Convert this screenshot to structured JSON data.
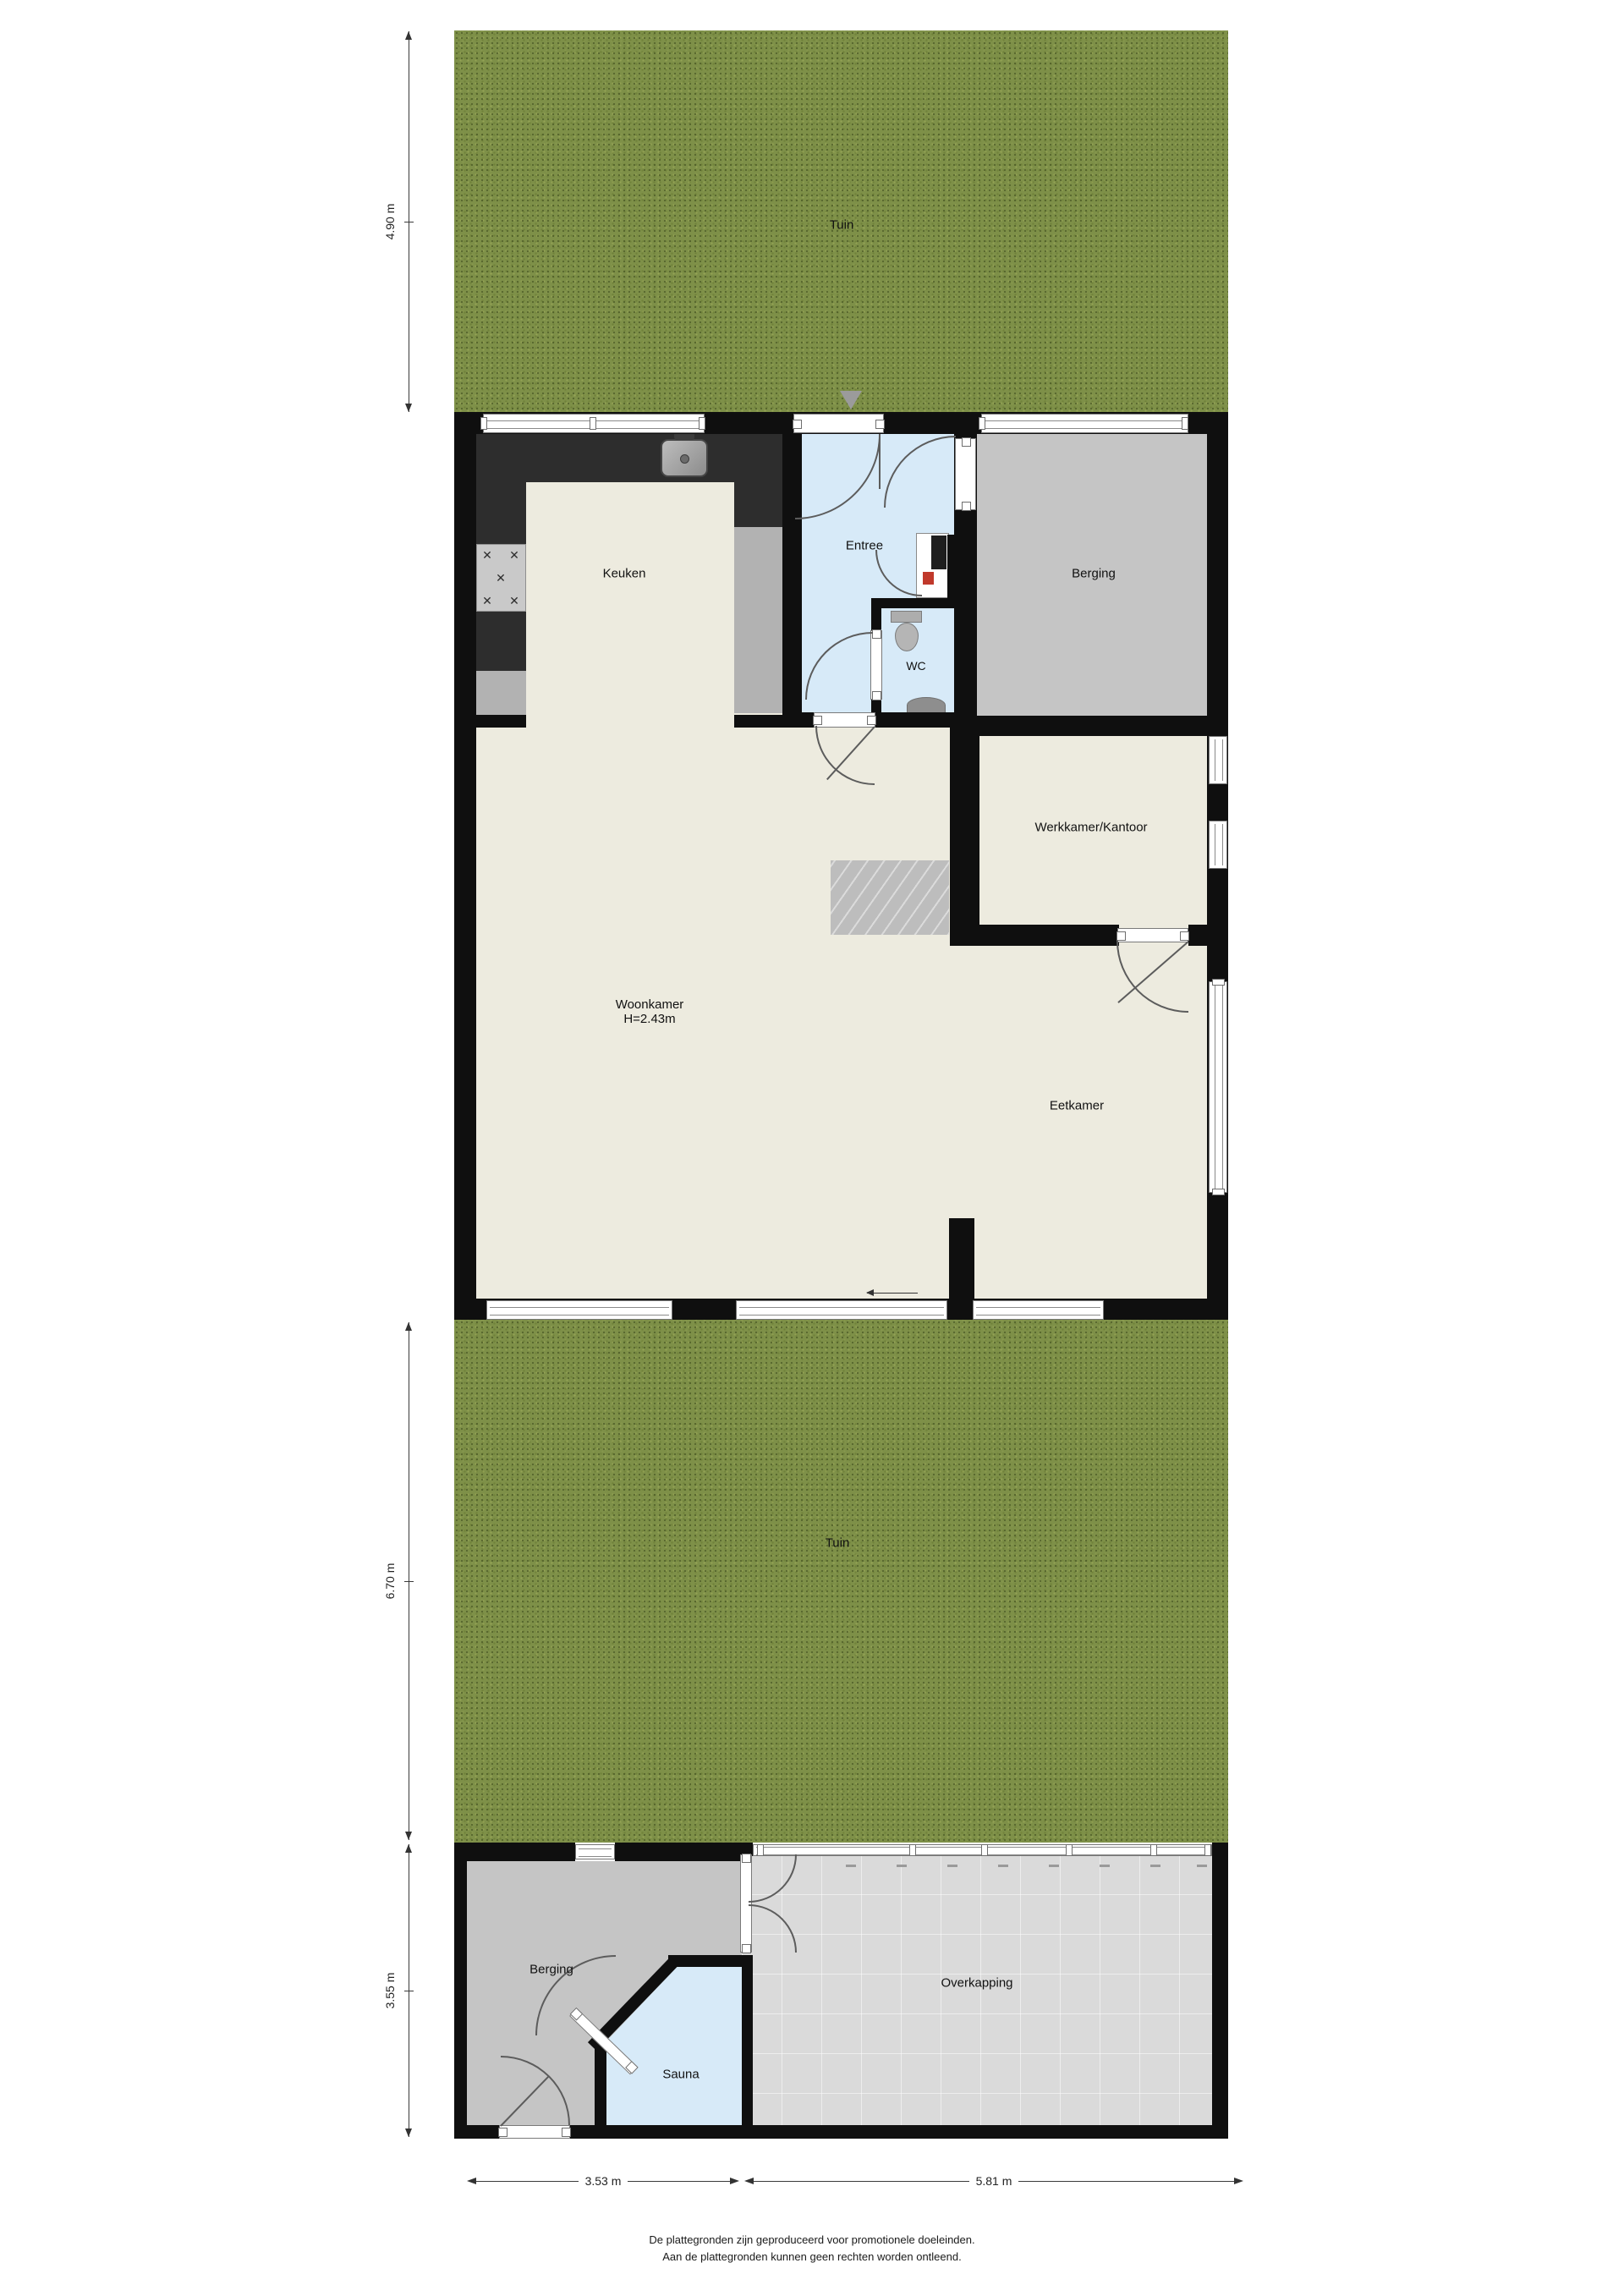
{
  "plan": {
    "rooms": {
      "tuin_top": "Tuin",
      "keuken": "Keuken",
      "entree": "Entree",
      "wc": "WC",
      "berging_top": "Berging",
      "werkkamer": "Werkkamer/Kantoor",
      "woonkamer": "Woonkamer",
      "woonkamer_height": "H=2.43m",
      "eetkamer": "Eetkamer",
      "tuin_bottom": "Tuin",
      "berging_bottom": "Berging",
      "sauna": "Sauna",
      "overkapping": "Overkapping"
    },
    "dimensions": {
      "tuin_top_depth": "4.90 m",
      "tuin_bottom_depth": "6.70 m",
      "outbuilding_depth": "3.55 m",
      "outbuilding_width_left": "3.53 m",
      "outbuilding_width_right": "5.81 m"
    },
    "disclaimer": {
      "line1": "De plattegronden zijn geproduceerd voor promotionele doeleinden.",
      "line2": "Aan de plattegronden kunnen geen rechten worden ontleend."
    },
    "icons": {
      "burner-icon": "✕",
      "entrance-marker-icon": "▼",
      "slide-arrow-icon": "←"
    },
    "colors": {
      "grass": "#7e9048",
      "floor": "#edebdf",
      "wall": "#0f0f0f",
      "wet_room": "#d7eaf8",
      "storage_floor": "#c5c5c5",
      "canopy_floor": "#dadada",
      "counter_dark": "#2d2d2d",
      "counter_light": "#b2b2b2"
    }
  }
}
